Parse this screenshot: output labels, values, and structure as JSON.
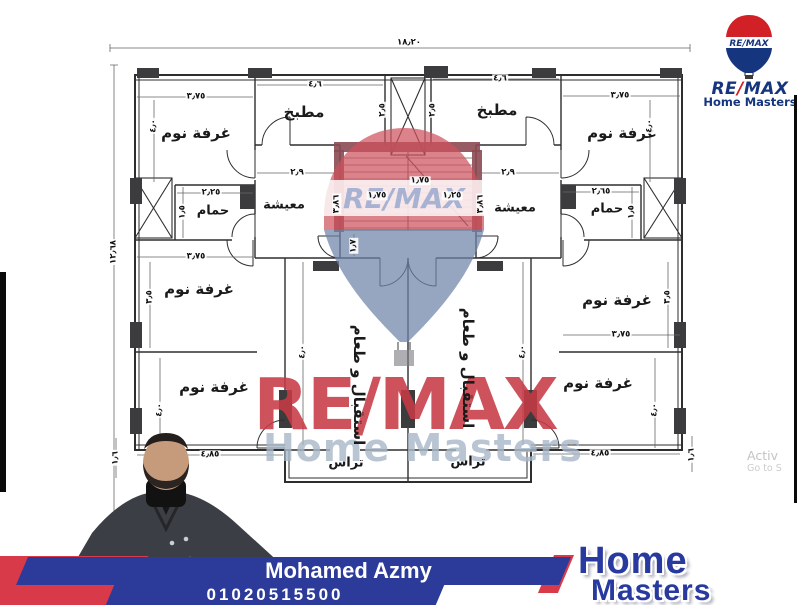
{
  "logo": {
    "re": "RE",
    "slash": "/",
    "max": "MAX",
    "sub": "Home Masters",
    "balloon_text": "RE/MAX"
  },
  "watermark": {
    "remax": "RE/MAX",
    "home_masters": "Home Masters",
    "balloon_text": "RE/MAX"
  },
  "agent": {
    "name": "Mohamed Azmy",
    "phone": "01020515500"
  },
  "footer_logo": {
    "line1": "Home",
    "line2": "Masters"
  },
  "system": {
    "activate1": "Activ",
    "activate2": "Go to S"
  },
  "rooms": {
    "bedroom": "غرفة نوم",
    "kitchen": "مطبخ",
    "bath": "حمام",
    "living": "معيشة",
    "reception": "استقبال و طعام",
    "terrace": "تراس"
  },
  "dims": {
    "overall_w": "١٨٫٢٠",
    "overall_h": "١٢٫٦٨",
    "bed_w": "٣٫٧٥",
    "bed_d": "٤٫٠",
    "kitchen_w": "٤٫٦",
    "shaft_side": "٢٫٥",
    "living_w": "٢٫٩",
    "living_d": "٣٫٨٦",
    "bath_w_left": "٢٫٢٥",
    "bath_w_right": "٢٫٦٥",
    "bath_d": "١٫٥",
    "midbed_d": "٣٫٥",
    "botbed_w": "٤٫٨٥",
    "terrace_edge": "١٫٦",
    "stair_run": "١٫٧٥",
    "stair_flight": "١٫٢٥",
    "landing_w": "١٫٧",
    "reception_d": "٤٫٠"
  },
  "colors": {
    "remax_red": "#d22027",
    "remax_blue": "#16357f",
    "banner_blue": "#2c3a99",
    "banner_red": "#d83a49",
    "stair_wall": "#8c4a52",
    "watermark_red": "#c73a46",
    "watermark_gray": "#a8b7c7"
  }
}
